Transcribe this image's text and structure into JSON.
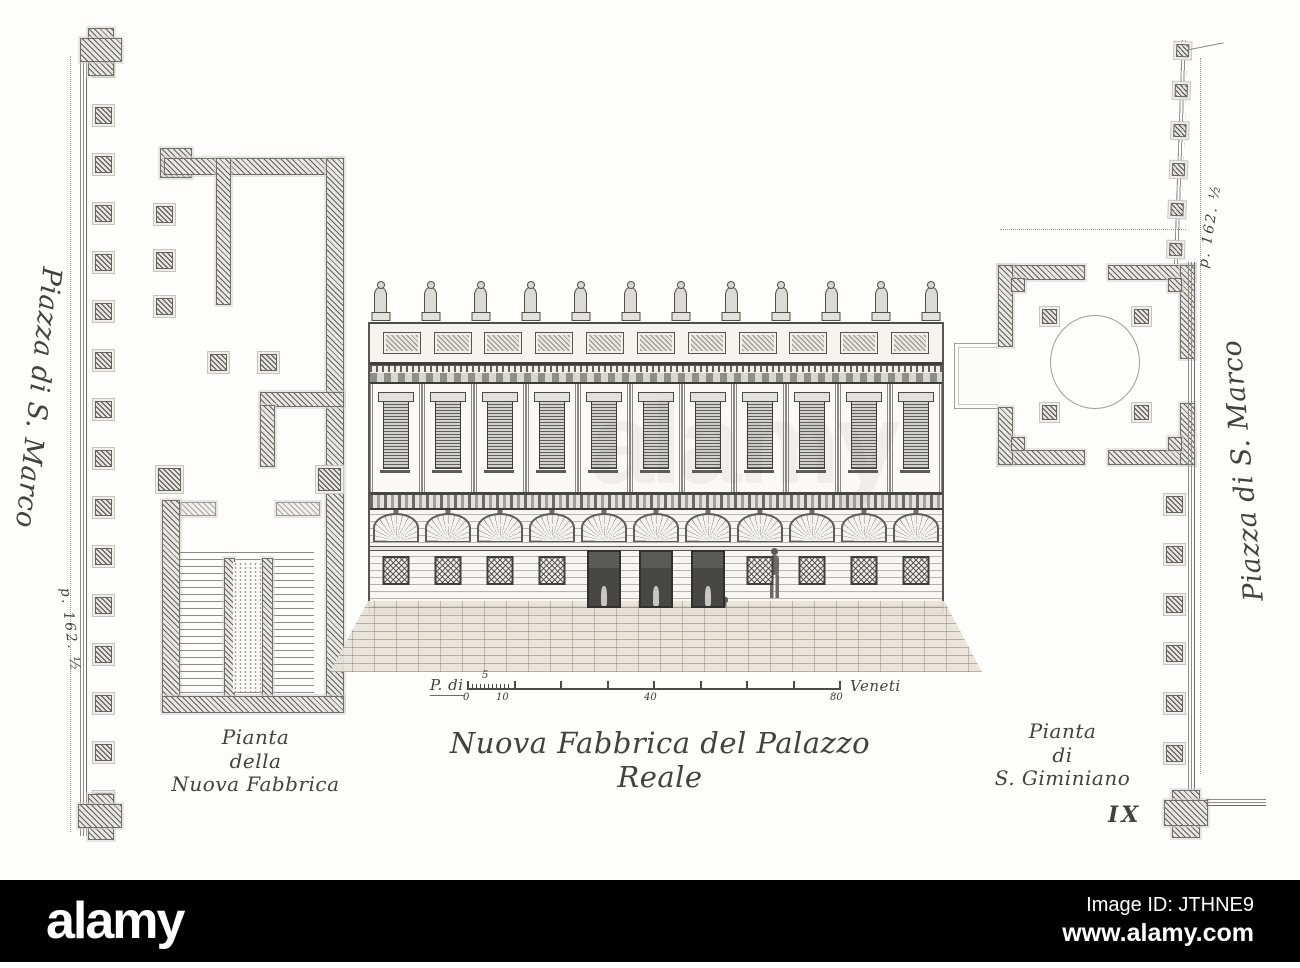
{
  "palette": {
    "paper": "#fdfdfc",
    "ink": "#3b3b3b",
    "hatch": "#6e6e6c",
    "footer_bg": "#000000",
    "footer_fg": "#ffffff"
  },
  "margins": {
    "left": {
      "street": "Piazza di S. Marco",
      "note": "p. 162. ½"
    },
    "right": {
      "street": "Piazza di S. Marco",
      "note": "p. 162. ½"
    }
  },
  "plans": {
    "left": {
      "caption": [
        "Pianta",
        "della",
        "Nuova Fabbrica"
      ]
    },
    "right": {
      "caption": [
        "Pianta",
        "di",
        "S. Giminiano"
      ]
    }
  },
  "elevation": {
    "caption": "Nuova Fabbrica del Palazzo Reale"
  },
  "scale_bar": {
    "prefix": "P. di",
    "above": "5",
    "labels": [
      "0",
      "10",
      "40",
      "80"
    ],
    "suffix": "Veneti"
  },
  "plate_number": "IX",
  "watermark": "alamy",
  "counts": {
    "statues": 12,
    "attic_panels": 11,
    "bays": 11,
    "left_piers": 16,
    "right_piers": 6,
    "right_top_piers": 6,
    "scale_ticks": 9
  },
  "footer": {
    "logo": "alamy",
    "image_id": "Image ID: JTHNE9",
    "website": "www.alamy.com"
  }
}
